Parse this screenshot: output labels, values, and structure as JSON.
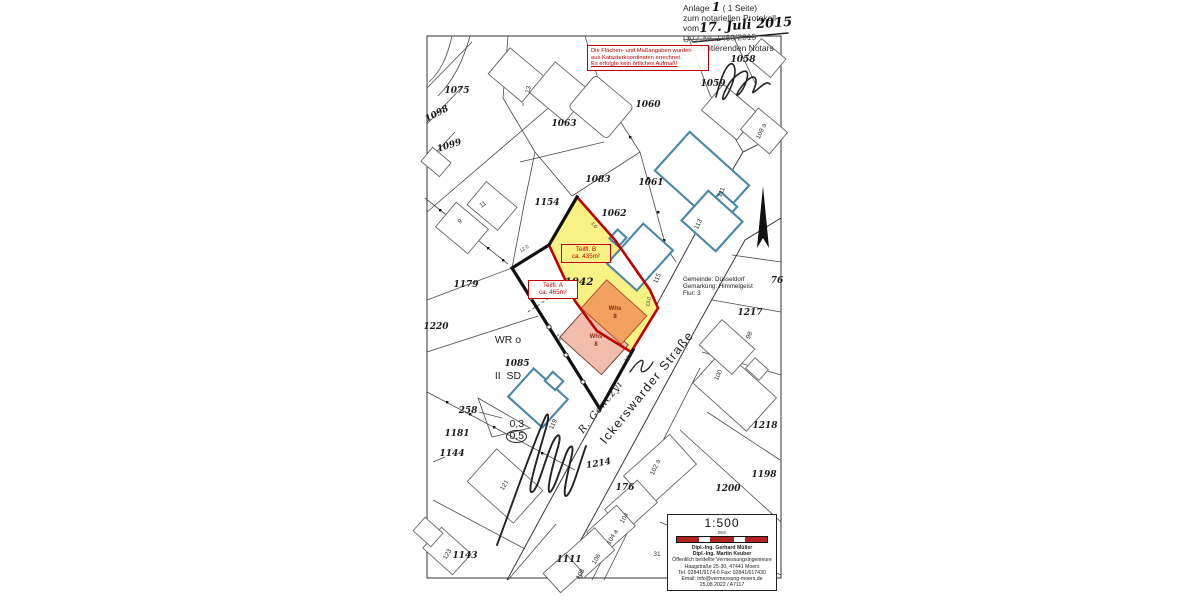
{
  "document_note": {
    "anlage_label": "Anlage",
    "anlage_number": "1",
    "pages_text": "( 1 Seite)",
    "line2": "zum notariellen Protokoll",
    "vom_label": "vom",
    "date_handwritten": "17. Juli 2015",
    "uvz_line": "UVZ-Nr. 1460/2015",
    "line5": "des amtierenden Notars"
  },
  "warning_box": {
    "lines": [
      "Die Flächen- und Maßangaben wurden",
      "aus Katasterkoordinaten errechnet.",
      "Es erfolgte kein örtliches Aufmaß!"
    ]
  },
  "location_block": {
    "lines": [
      "Gemeinde: Düsseldorf",
      "Gemarkung: Himmelgeist",
      "Flur: 3"
    ]
  },
  "zoning_label": {
    "line1": "WR o",
    "line2": "II  SD",
    "ratio_left": "0,3",
    "ratio_circled": "0,5"
  },
  "area_labels": {
    "teilflaeche_a": {
      "title": "Teilfl. A",
      "area": "ca. 465m²"
    },
    "teilflaeche_b": {
      "title": "Teilfl. B",
      "area": "ca. 435m²"
    }
  },
  "street": {
    "name": "Ickerswarder Straße"
  },
  "handwriting": {
    "owner_annotation": "R. Gonczyi"
  },
  "scale_box": {
    "scale": "1:500",
    "bar_label": "25m",
    "firm": [
      "Dipl.-Ing. Gerhard Müller",
      "Dipl.-Ing. Martin Keuber",
      "Öffentlich bestellte Vermessungsingenieure",
      "Haagstraße 25-30, 47441 Moers",
      "Tel. 02841/9174-0 Fax: 02841/617430",
      "Email: info@vermessung-moers.de",
      "25.08.2022 / A7117"
    ]
  },
  "map_labels": {
    "parcel_labels": [
      {
        "text": "1075",
        "x": 457,
        "y": 93
      },
      {
        "text": "1098",
        "x": 438,
        "y": 116,
        "rot": -28
      },
      {
        "text": "1099",
        "x": 450,
        "y": 148,
        "rot": -18
      },
      {
        "text": "1063",
        "x": 564,
        "y": 126
      },
      {
        "text": "1060",
        "x": 648,
        "y": 107
      },
      {
        "text": "1059",
        "x": 713,
        "y": 86
      },
      {
        "text": "1058",
        "x": 743,
        "y": 62
      },
      {
        "text": "1083",
        "x": 598,
        "y": 182
      },
      {
        "text": "1061",
        "x": 651,
        "y": 185
      },
      {
        "text": "1154",
        "x": 547,
        "y": 205
      },
      {
        "text": "1062",
        "x": 614,
        "y": 216
      },
      {
        "text": "1042",
        "x": 579,
        "y": 285,
        "cls": "big"
      },
      {
        "text": "1179",
        "x": 466,
        "y": 287
      },
      {
        "text": "1220",
        "x": 436,
        "y": 329
      },
      {
        "text": "1085",
        "x": 517,
        "y": 366
      },
      {
        "text": "258",
        "x": 468,
        "y": 413
      },
      {
        "text": "1181",
        "x": 457,
        "y": 436
      },
      {
        "text": "1144",
        "x": 452,
        "y": 456
      },
      {
        "text": "1143",
        "x": 465,
        "y": 558
      },
      {
        "text": "1111",
        "x": 569,
        "y": 562
      },
      {
        "text": "1214",
        "x": 599,
        "y": 466,
        "rot": -10
      },
      {
        "text": "176",
        "x": 625,
        "y": 490
      },
      {
        "text": "1200",
        "x": 728,
        "y": 491
      },
      {
        "text": "1218",
        "x": 765,
        "y": 428
      },
      {
        "text": "1198",
        "x": 764,
        "y": 477
      },
      {
        "text": "1217",
        "x": 750,
        "y": 315
      },
      {
        "text": "76",
        "x": 777,
        "y": 283
      }
    ],
    "building_labels": [
      {
        "text": "9",
        "x": 461,
        "y": 223,
        "rot": -35
      },
      {
        "text": "11",
        "x": 484,
        "y": 206,
        "rot": -35
      },
      {
        "text": "13",
        "x": 530,
        "y": 90,
        "rot": -75
      },
      {
        "text": "109 a",
        "x": 763,
        "y": 132,
        "rot": -65
      },
      {
        "text": "111",
        "x": 723,
        "y": 193,
        "rot": -65
      },
      {
        "text": "113",
        "x": 700,
        "y": 225,
        "rot": -65
      },
      {
        "text": "115",
        "x": 659,
        "y": 279,
        "rot": -65
      },
      {
        "text": "119",
        "x": 555,
        "y": 425,
        "rot": -65
      },
      {
        "text": "121",
        "x": 506,
        "y": 486,
        "rot": -60
      },
      {
        "text": "123",
        "x": 449,
        "y": 555,
        "rot": -60
      },
      {
        "text": "100",
        "x": 720,
        "y": 376,
        "rot": -65
      },
      {
        "text": "98",
        "x": 751,
        "y": 336,
        "rot": -65
      },
      {
        "text": "102 a",
        "x": 657,
        "y": 468,
        "rot": -65
      },
      {
        "text": "104",
        "x": 626,
        "y": 519,
        "rot": -60
      },
      {
        "text": "104 a",
        "x": 614,
        "y": 538,
        "rot": -60
      },
      {
        "text": "106",
        "x": 598,
        "y": 560,
        "rot": -60
      },
      {
        "text": "108",
        "x": 582,
        "y": 575,
        "rot": -60
      },
      {
        "text": "31",
        "x": 657,
        "y": 556
      }
    ],
    "dimension_labels": [
      {
        "text": "12.0",
        "x": 525,
        "y": 250,
        "rot": -33
      },
      {
        "text": "1.0",
        "x": 593,
        "y": 226,
        "rot": 50
      },
      {
        "text": "13.0",
        "x": 650,
        "y": 302,
        "rot": -80
      },
      {
        "text": "3.9",
        "x": 557,
        "y": 338,
        "rot": 56
      },
      {
        "text": "3.24",
        "x": 629,
        "y": 359,
        "rot": -48
      }
    ],
    "whs_labels": [
      {
        "text": "Whs",
        "x": 615,
        "y": 310
      },
      {
        "text": "8",
        "x": 615,
        "y": 318
      },
      {
        "text": "Whs",
        "x": 596,
        "y": 338
      },
      {
        "text": "8",
        "x": 596,
        "y": 346
      }
    ]
  },
  "colors": {
    "accent_red": "#C00000",
    "highlight_yellow": "#F8F183",
    "building_orange": "#F2A25E",
    "building_pink": "#F3BDAD",
    "blue_building_outline": "#4A86A6",
    "scale_bar_red": "#B22222"
  }
}
